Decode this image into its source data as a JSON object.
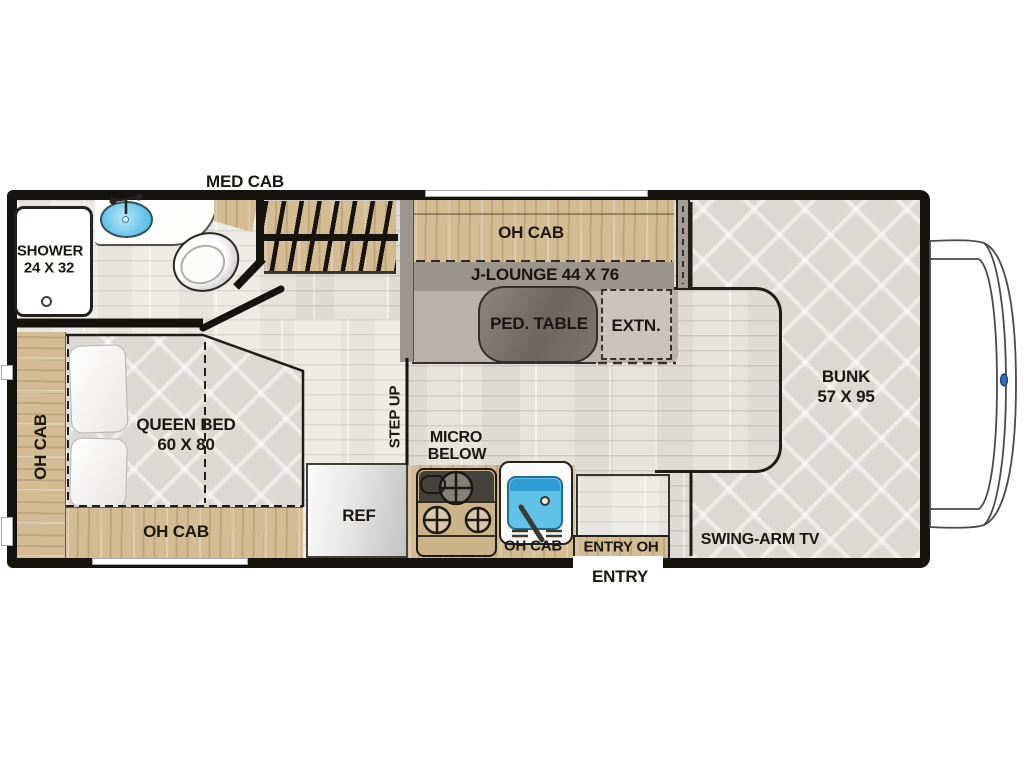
{
  "title": "RV motorhome floor plan",
  "labels": {
    "med_cab": "MED CAB",
    "shower_l1": "SHOWER",
    "shower_l2": "24 X 32",
    "oh_cab_left": "OH CAB",
    "queen_l1": "QUEEN BED",
    "queen_l2": "60 X 80",
    "oh_cab_bed": "OH CAB",
    "ref": "REF",
    "step_up": "STEP UP",
    "micro_l1": "MICRO",
    "micro_l2": "BELOW",
    "oh_cab_dinette": "OH CAB",
    "jlounge": "J-LOUNGE 44 X 76",
    "ped_table": "PED. TABLE",
    "extn": "EXTN.",
    "oh_cab_kitchen": "OH CAB",
    "entry_oh": "ENTRY OH",
    "entry": "ENTRY",
    "swing_arm_tv": "SWING-ARM TV",
    "bunk_l1": "BUNK",
    "bunk_l2": "57 X 95"
  },
  "fixtures": [
    "shower",
    "bathroom-sink",
    "toilet",
    "medicine-cabinet",
    "wardrobe-ladder",
    "queen-bed",
    "pillow",
    "overhead-cabinet",
    "refrigerator",
    "stove",
    "kitchen-sink",
    "j-lounge",
    "pedestal-table",
    "table-extension",
    "entry-landing",
    "bunk",
    "cab-front",
    "ford-logo"
  ],
  "colors": {
    "wall": "#16130f",
    "floor": "#e6e3dd",
    "wood": "#d3bb92",
    "quilt": "#dcd9d4",
    "lounge_gray": "#b7b2aa",
    "table_gray": "#6e675e",
    "sink_blue": "#5fc1e6",
    "logo_blue": "#2f6db8",
    "label_text": "#1b1813"
  }
}
